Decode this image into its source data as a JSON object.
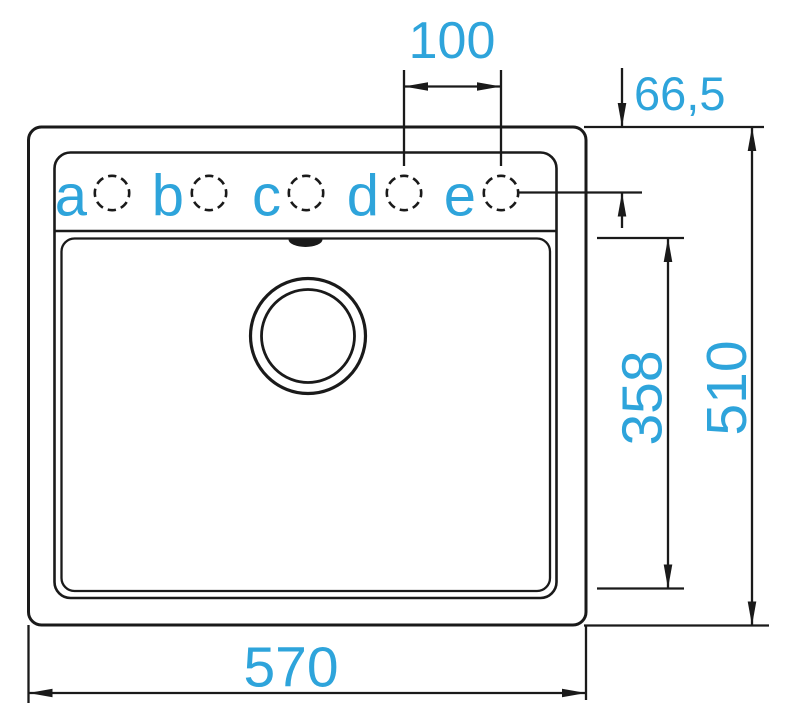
{
  "diagram": {
    "kind": "sink-technical-drawing-top-view",
    "colors": {
      "accent": "#2ea4db",
      "line": "#1a1a1a",
      "background": "#ffffff"
    },
    "tap_hole_labels": [
      "a",
      "b",
      "c",
      "d",
      "e"
    ],
    "dimensions": {
      "hole_spacing_d_e": "100",
      "hole_center_offset": "66,5",
      "basin_inner_depth": "358",
      "overall_depth": "510",
      "overall_width": "570"
    }
  }
}
